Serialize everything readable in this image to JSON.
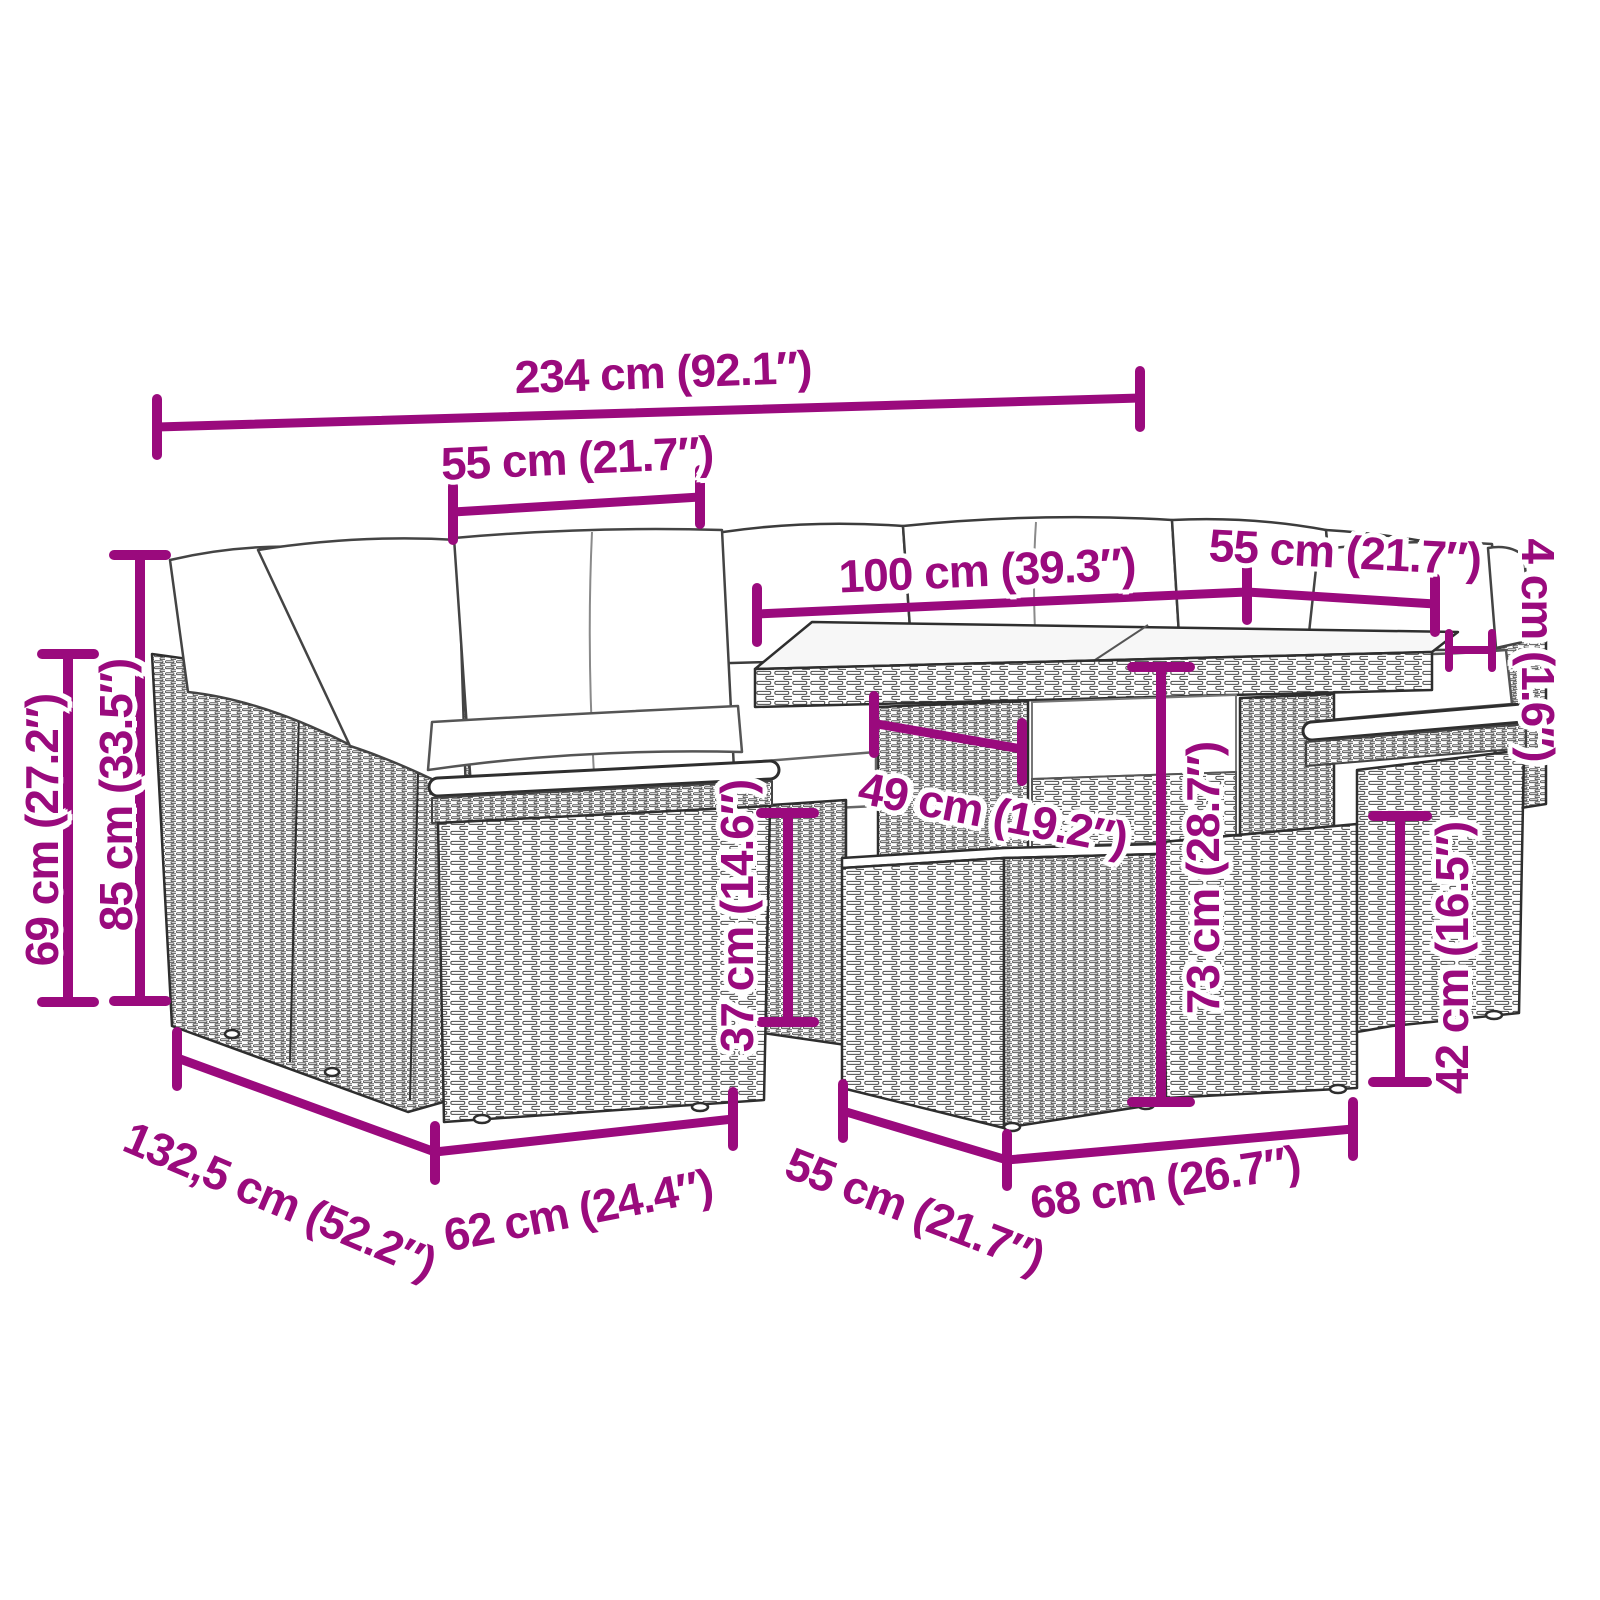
{
  "illustration": {
    "type": "product-dimension-diagram",
    "subject": "poly rattan garden lounge set: corner sofa modules with cushions, glass-top table and footstool",
    "colors": {
      "dimension_accent": "#9A0A7D",
      "line_art": "#2e2e2e",
      "background": "#ffffff"
    }
  },
  "dimensions": [
    {
      "id": "overall-width",
      "label": "234 cm (92.1″)"
    },
    {
      "id": "seat-width-left",
      "label": "55 cm (21.7″)"
    },
    {
      "id": "table-length",
      "label": "100 cm (39.3″)"
    },
    {
      "id": "seat-width-right",
      "label": "55 cm (21.7″)"
    },
    {
      "id": "tabletop-thickness",
      "label": "4 cm (1.6″)"
    },
    {
      "id": "armrest-height",
      "label": "69 cm (27.2″)"
    },
    {
      "id": "back-height",
      "label": "85 cm (33.5″)"
    },
    {
      "id": "table-clearance",
      "label": "49 cm (19.2″)"
    },
    {
      "id": "seat-height",
      "label": "37 cm (14.6″)"
    },
    {
      "id": "table-height",
      "label": "73 cm (28.7″)"
    },
    {
      "id": "footstool-height",
      "label": "42 cm (16.5″)"
    },
    {
      "id": "sofa-depth",
      "label": "132,5 cm (52.2″)"
    },
    {
      "id": "module-width",
      "label": "62 cm (24.4″)"
    },
    {
      "id": "footstool-depth",
      "label": "55 cm (21.7″)"
    },
    {
      "id": "footstool-width",
      "label": "68 cm (26.7″)"
    }
  ]
}
